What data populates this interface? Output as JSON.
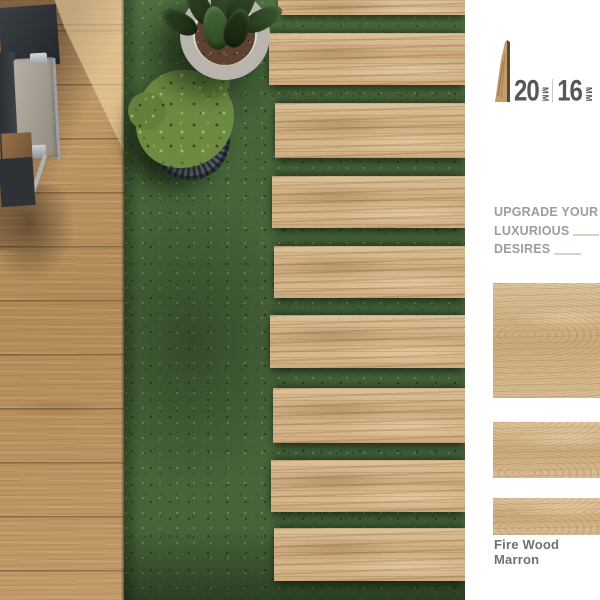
{
  "thickness": {
    "options": [
      {
        "value": "20",
        "unit": "MM"
      },
      {
        "value": "16",
        "unit": "MM"
      }
    ]
  },
  "headline": {
    "lines": [
      "UPGRADE YOUR",
      "LUXURIOUS",
      "DESIRES"
    ]
  },
  "product": {
    "name": "Fire Wood Marron"
  },
  "photo": {
    "plank_count": 9
  },
  "swatches": [
    {
      "name": "large"
    },
    {
      "name": "medium"
    },
    {
      "name": "small"
    }
  ],
  "icons": {
    "thickness_profile": "plank-profile-icon"
  },
  "colors": {
    "wood": "#c9a473",
    "wood_light": "#dcc096",
    "wood_dark": "#8a6742",
    "wedge_edge": "#5c4531",
    "grass": "#46633a",
    "grass_shadow": "#2c4224",
    "digits": "#54575b",
    "headline_text": "#989ea1",
    "label_text": "#6e7174",
    "rule": "#d9d3c6",
    "panel_bg": "#ffffff"
  }
}
